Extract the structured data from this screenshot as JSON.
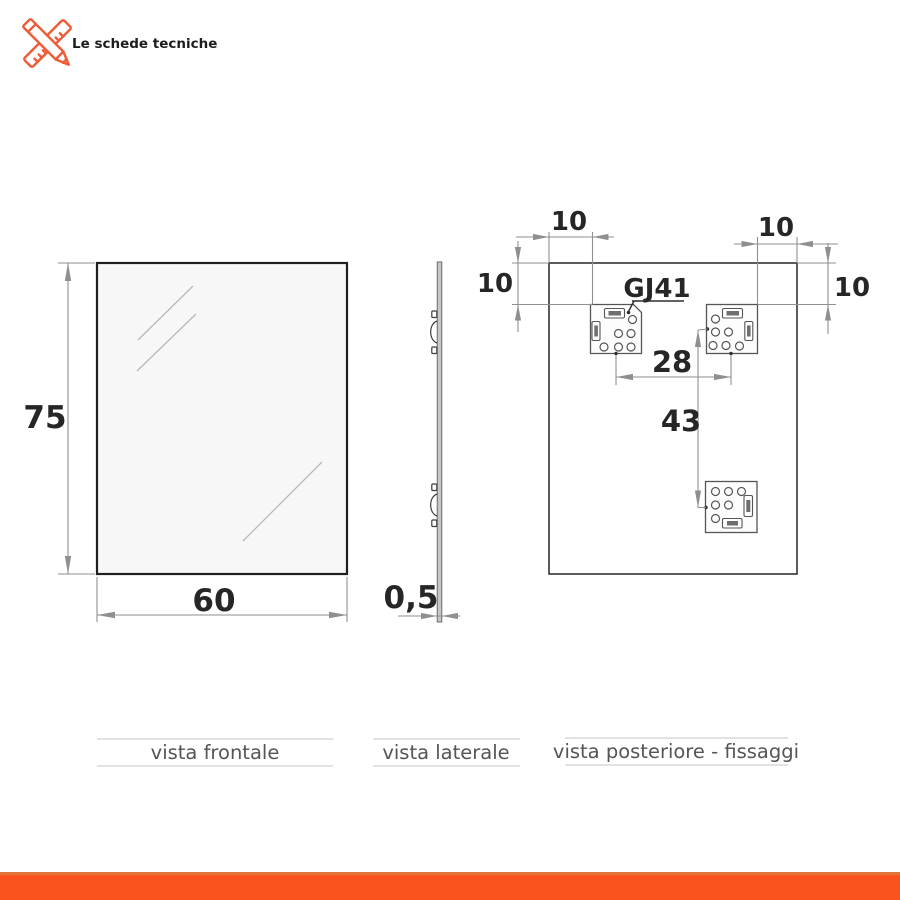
{
  "brand": {
    "name": "Le schede tecniche",
    "icon": "pencil-ruler-cross-icon",
    "accent_color": "#EE5B35"
  },
  "views": {
    "front": {
      "caption": "vista frontale",
      "height": "75",
      "width": "60"
    },
    "side": {
      "caption": "vista laterale",
      "thickness": "0,5"
    },
    "rear": {
      "caption": "vista posteriore - fissaggi",
      "fixing_code": "GJ41",
      "offset_top_left": "10",
      "offset_top_right": "10",
      "offset_left": "10",
      "offset_right": "10",
      "spacing_horizontal": "28",
      "spacing_vertical": "43"
    }
  },
  "colors": {
    "accent": "#EE5B35",
    "footer_bar": "#FA531D",
    "dim_lines": "#8f8f8f",
    "drawing_lines": "#2f2f2f"
  }
}
